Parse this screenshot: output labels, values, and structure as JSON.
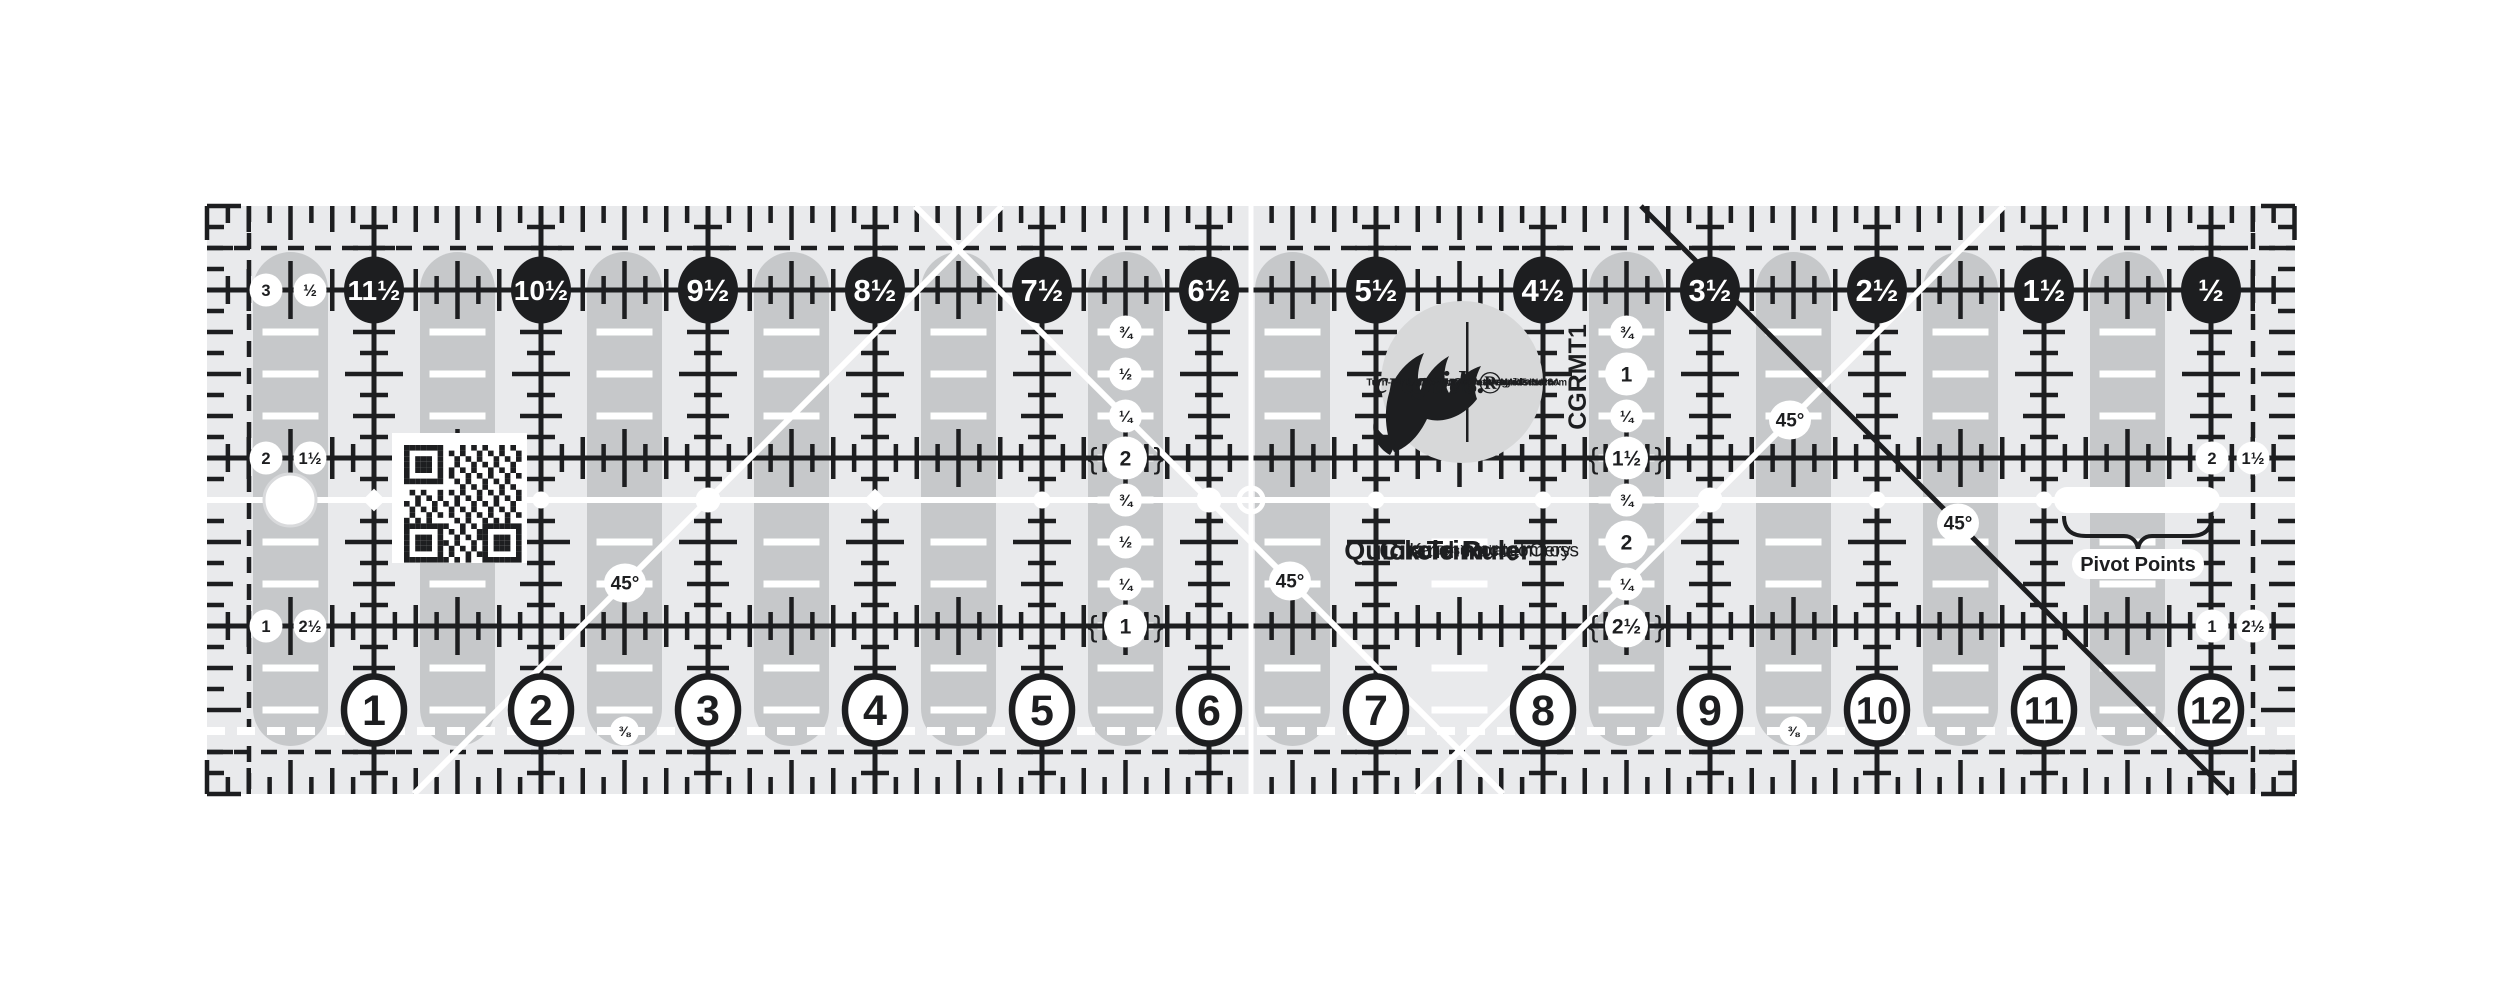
{
  "page": {
    "background": "#ffffff"
  },
  "ruler": {
    "product_code": "CGRMT1",
    "colors": {
      "body": "#e9eaec",
      "slot": "#c6c8ca",
      "ink": "#1d1e20",
      "white": "#ffffff",
      "logo_bg": "#d7d8d9",
      "hole_ring": "#d9dadc"
    },
    "top_scale": {
      "labels": [
        "11½",
        "10½",
        "9½",
        "8½",
        "7½",
        "6½",
        "5½",
        "4½",
        "3½",
        "2½",
        "1½",
        "½"
      ]
    },
    "bottom_scale": {
      "labels": [
        "1",
        "2",
        "3",
        "4",
        "5",
        "6",
        "7",
        "8",
        "9",
        "10",
        "11",
        "12"
      ]
    },
    "left_edge_rows": [
      {
        "row": 0.5,
        "outer": "3",
        "inner": "½"
      },
      {
        "row": 1.5,
        "outer": "2",
        "inner": "1½"
      },
      {
        "row": 2.5,
        "outer": "1",
        "inner": "2½"
      }
    ],
    "right_edge_rows": [
      {
        "row": 1.5,
        "inner": "2",
        "outer": "1½"
      },
      {
        "row": 2.5,
        "inner": "1",
        "outer": "2½"
      }
    ],
    "mid_columns": [
      {
        "x_in": 5.5,
        "items": [
          {
            "row": 0.75,
            "t": "¾"
          },
          {
            "row": 1,
            "t": "½"
          },
          {
            "row": 1.25,
            "t": "¼"
          },
          {
            "row": 1.5,
            "t": "2",
            "big": true,
            "braces": true,
            "upright": true
          },
          {
            "row": 1.75,
            "t": "¾"
          },
          {
            "row": 2,
            "t": "½"
          },
          {
            "row": 2.25,
            "t": "¼"
          },
          {
            "row": 2.5,
            "t": "1",
            "big": true,
            "braces": true,
            "upright": true
          }
        ]
      },
      {
        "x_in": 8.5,
        "items": [
          {
            "row": 0.75,
            "t": "¾"
          },
          {
            "row": 1,
            "t": "1",
            "big": true,
            "upright": true
          },
          {
            "row": 1.25,
            "t": "¼"
          },
          {
            "row": 1.5,
            "t": "1½",
            "big": true,
            "braces": true
          },
          {
            "row": 1.75,
            "t": "¾"
          },
          {
            "row": 2,
            "t": "2",
            "big": true,
            "upright": true
          },
          {
            "row": 2.25,
            "t": "¼"
          },
          {
            "row": 2.5,
            "t": "2½",
            "big": true,
            "braces": true
          }
        ]
      }
    ],
    "eighth_labels": [
      {
        "x_in": 2.5,
        "t": "⅜"
      },
      {
        "x_in": 9.5,
        "t": "⅜"
      }
    ],
    "angle_labels": [
      {
        "x": 625,
        "y": 583,
        "t": "45°"
      },
      {
        "x": 1290,
        "y": 581,
        "t": "45°"
      },
      {
        "x": 1790,
        "y": 420,
        "t": "45°"
      },
      {
        "x": 1958,
        "y": 523,
        "t": "45°"
      }
    ],
    "pivot": {
      "label": "Pivot Points",
      "markers": [
        {
          "in": 1,
          "type": "diamond"
        },
        {
          "in": 2,
          "type": "dot"
        },
        {
          "in": 3,
          "type": "big"
        },
        {
          "in": 4,
          "type": "diamond"
        },
        {
          "in": 5,
          "type": "dot"
        },
        {
          "in": 6,
          "type": "big"
        },
        {
          "in": 7,
          "type": "dot"
        },
        {
          "in": 8,
          "type": "dot"
        },
        {
          "in": 9,
          "type": "big"
        },
        {
          "in": 10,
          "type": "dot"
        },
        {
          "in": 11,
          "type": "dot"
        }
      ]
    },
    "logo": {
      "lines": [
        {
          "t": "Turn-a-Round™",
          "x": 1404,
          "s": 10,
          "w": 700
        },
        {
          "t": "creative.",
          "x": 1430,
          "s": 32,
          "w": 700,
          "script": true
        },
        {
          "t": "grids®",
          "x": 1457,
          "s": 32,
          "w": 700,
          "script": true
        },
        {
          "t": "The Original NON-SLIP Ruler",
          "x": 1470,
          "s": 7,
          "w": 700
        },
        {
          "t": "UK - www.creativegrids.com",
          "x": 1480,
          "s": 10,
          "w": 700,
          "len": 148
        },
        {
          "t": "USA - www.creativegridsusa.com",
          "x": 1491,
          "s": 10,
          "w": 700,
          "len": 152
        },
        {
          "t": "© 2014 Creative Grids •",
          "x": 1502,
          "s": 7.5,
          "w": 400
        },
        {
          "t": "Euro. Pat. # 13228098",
          "x": 1509,
          "s": 7.5,
          "w": 400
        },
        {
          "t": "U.S. Pat. # 6,925,724",
          "x": 1516,
          "s": 7.5,
          "w": 400
        },
        {
          "t": "MADE IN USA",
          "x": 1530,
          "s": 9,
          "w": 700,
          "tilt": -62
        }
      ]
    },
    "title_block": {
      "lines": [
        {
          "t": "Quick Trim",
          "x": 1414,
          "s": 27,
          "w": 700
        },
        {
          "t": "and",
          "x": 1434,
          "s": 23,
          "w": 700
        },
        {
          "t": "Circle Ruler",
          "x": 1455,
          "s": 27,
          "w": 700
        },
        {
          "t": "Designed by",
          "x": 1473,
          "s": 13,
          "w": 400
        },
        {
          "t": "Karen Montgomery",
          "x": 1490,
          "s": 19,
          "w": 400
        },
        {
          "t": "and",
          "x": 1506,
          "s": 14,
          "w": 400
        },
        {
          "t": "Rachel Cross",
          "x": 1522,
          "s": 19,
          "w": 400
        }
      ]
    }
  }
}
